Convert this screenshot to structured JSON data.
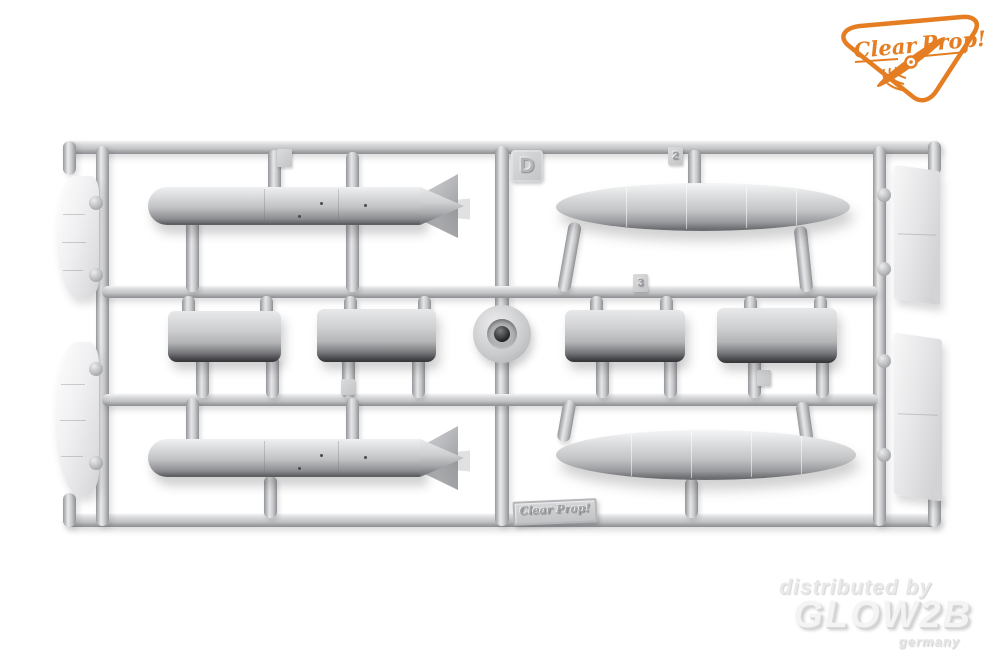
{
  "background_color": "#ffffff",
  "brand_logo": {
    "name": "Clear Prop!",
    "text_clear": "Clear",
    "text_prop": "Prop!",
    "color": "#e57e22"
  },
  "sprue": {
    "letter": "D",
    "plastic_color": "#c9cacc",
    "nameplate": "Clear Prop!",
    "part_tags": {
      "tag_2": "2",
      "tag_3": "3"
    },
    "parts": [
      {
        "id": "finned-drop-tank-top-left",
        "desc": "drop tank with tail fins"
      },
      {
        "id": "streamlined-drop-tank-top-right",
        "desc": "streamlined drop tank"
      },
      {
        "id": "tank-half-shell-x4",
        "desc": "tank centre half shells"
      },
      {
        "id": "finned-drop-tank-bottom-left",
        "desc": "drop tank with tail fins"
      },
      {
        "id": "streamlined-drop-tank-bottom-right",
        "desc": "streamlined drop tank"
      },
      {
        "id": "curved-fairing-panels-left",
        "desc": "curved fairing panels"
      },
      {
        "id": "flat-pylon-panels-right",
        "desc": "flat pylon panels"
      },
      {
        "id": "round-cap-centre",
        "desc": "round cap part at sprue centre"
      }
    ]
  },
  "watermark": {
    "line1": "distributed by",
    "line2": "GLOW2B",
    "line3": "germany"
  }
}
